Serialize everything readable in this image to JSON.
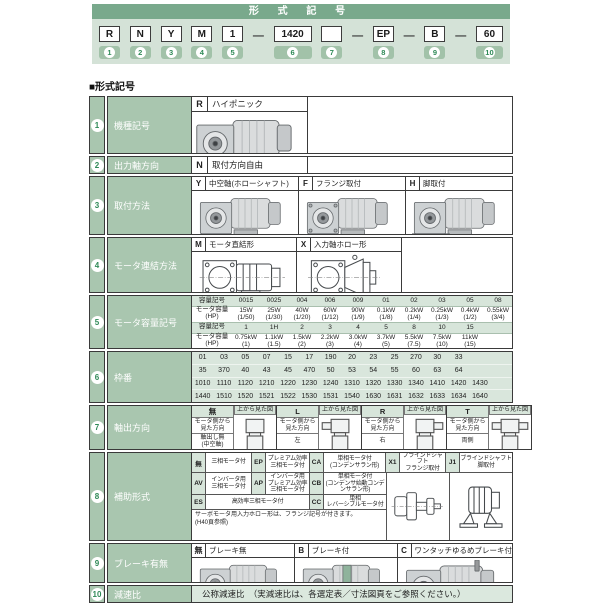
{
  "header": {
    "title": "形 式 記 号",
    "section_heading": "■形式記号",
    "dash": "—"
  },
  "colors": {
    "header_green": "#79a98c",
    "band_green": "#d4e2d7",
    "cell_green": "#a9c6af",
    "light_green": "#d7e5da",
    "number_green": "#2f8a57"
  },
  "code_row": [
    {
      "value": "R",
      "badge": "1"
    },
    {
      "value": "N",
      "badge": "2"
    },
    {
      "value": "Y",
      "badge": "3"
    },
    {
      "value": "M",
      "badge": "4"
    },
    {
      "value": "1",
      "badge": "5"
    },
    {
      "value": "1420",
      "badge": "6"
    },
    {
      "value": "",
      "badge": "7"
    },
    {
      "value": "EP",
      "badge": "8"
    },
    {
      "value": "B",
      "badge": "9"
    },
    {
      "value": "60",
      "badge": "10"
    }
  ],
  "rows": {
    "r1": {
      "num": "1",
      "label": "機種記号",
      "code": "R",
      "desc": "ハイポニック"
    },
    "r2": {
      "num": "2",
      "label": "出力軸方向",
      "code": "N",
      "desc": "取付方向自由"
    },
    "r3": {
      "num": "3",
      "label": "取付方法",
      "items": [
        {
          "code": "Y",
          "desc": "中空軸(ホローシャフト)"
        },
        {
          "code": "F",
          "desc": "フランジ取付"
        },
        {
          "code": "H",
          "desc": "脚取付"
        }
      ]
    },
    "r4": {
      "num": "4",
      "label": "モータ連結方法",
      "items": [
        {
          "code": "M",
          "desc": "モータ直結形"
        },
        {
          "code": "X",
          "desc": "入力軸ホロー形"
        }
      ]
    },
    "r5": {
      "num": "5",
      "label": "モータ容量記号",
      "sym_header": "容量記号",
      "cap_header": "モータ容量\n(HP)",
      "symbols1": [
        "0015",
        "0025",
        "004",
        "006",
        "009",
        "01",
        "02",
        "03",
        "05",
        "08"
      ],
      "caps1": [
        "15W\n(1/50)",
        "25W\n(1/30)",
        "40W\n(1/20)",
        "60W\n(1/12)",
        "90W\n(1/9)",
        "0.1kW\n(1/8)",
        "0.2kW\n(1/4)",
        "0.25kW\n(1/3)",
        "0.4kW\n(1/2)",
        "0.55kW\n(3/4)"
      ],
      "symbols2": [
        "1",
        "1H",
        "2",
        "3",
        "4",
        "5",
        "8",
        "10",
        "15",
        ""
      ],
      "caps2": [
        "0.75kW\n(1)",
        "1.1kW\n(1.5)",
        "1.5kW\n(2)",
        "2.2kW\n(3)",
        "3.0kW\n(4)",
        "3.7kW\n(5)",
        "5.5kW\n(7.5)",
        "7.5kW\n(10)",
        "11kW\n(15)",
        ""
      ]
    },
    "r6": {
      "num": "6",
      "label": "枠番",
      "line1": [
        "01",
        "03",
        "05",
        "07",
        "15",
        "17",
        "190",
        "20",
        "23",
        "25",
        "270",
        "30",
        "33",
        "",
        ""
      ],
      "line2": [
        "35",
        "370",
        "40",
        "43",
        "45",
        "470",
        "50",
        "53",
        "54",
        "55",
        "60",
        "63",
        "64",
        "",
        ""
      ],
      "line3": [
        "1010",
        "1110",
        "1120",
        "1210",
        "1220",
        "1230",
        "1240",
        "1310",
        "1320",
        "1330",
        "1340",
        "1410",
        "1420",
        "1430",
        ""
      ],
      "line4": [
        "1440",
        "1510",
        "1520",
        "1521",
        "1522",
        "1530",
        "1531",
        "1540",
        "1630",
        "1631",
        "1632",
        "1633",
        "1634",
        "1640",
        ""
      ]
    },
    "r7": {
      "num": "7",
      "label": "軸出方向",
      "view_label": "モータ側から\n見た方向",
      "top_label": "上から見た図",
      "items": [
        {
          "code": "無",
          "dir": "軸出し無\n(中空軸)"
        },
        {
          "code": "L",
          "dir": "左"
        },
        {
          "code": "R",
          "dir": "右"
        },
        {
          "code": "T",
          "dir": "両側"
        }
      ]
    },
    "r8": {
      "num": "8",
      "label": "補助形式",
      "row1": [
        {
          "code": "無",
          "desc": "三相モータ付"
        },
        {
          "code": "EP",
          "desc": "プレミアム効率\n三相モータ付"
        },
        {
          "code": "CA",
          "desc": "単相モータ付\n(コンデンサラン形)"
        },
        {
          "code": "X1",
          "desc": "ブラインドシャフト\nフランジ取付"
        },
        {
          "code": "J1",
          "desc": "ブラインドシャフト\n脚取付"
        }
      ],
      "row2": [
        {
          "code": "AV",
          "desc": "インバータ用\n三相モータ付"
        },
        {
          "code": "AP",
          "desc": "インバータ用\nプレミアム効率\n三相モータ付"
        },
        {
          "code": "CB",
          "desc": "単相モータ付\n(コンデンサ始動コンデンサラン形)"
        }
      ],
      "row3": [
        {
          "code": "ES",
          "desc": "高効率三相モータ付"
        },
        {
          "code": "CC",
          "desc": "単相\nレバーシブルモータ付"
        }
      ],
      "note": "サーボモータ用入力ホロー形は、フランジ記号が付きます。\n(H40頁参照)"
    },
    "r9": {
      "num": "9",
      "label": "ブレーキ有無",
      "items": [
        {
          "code": "無",
          "desc": "ブレーキ無"
        },
        {
          "code": "B",
          "desc": "ブレーキ付"
        },
        {
          "code": "C",
          "desc": "ワンタッチゆるめブレーキ付"
        }
      ]
    },
    "r10": {
      "num": "10",
      "label": "減速比",
      "desc": "公称減速比　（実減速比は、各選定表／寸法図頁をご参照ください。）"
    }
  }
}
